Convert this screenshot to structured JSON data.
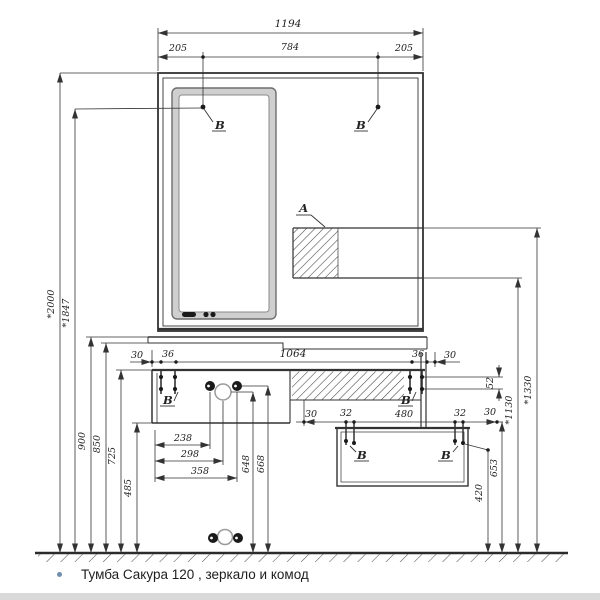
{
  "caption": {
    "bullet": "",
    "text": "Тумба Сакура 120 , зеркало и комод"
  },
  "labels": {
    "detail_a": "А",
    "detail_b": "В"
  },
  "dims": {
    "top": {
      "total": "1194",
      "left": "205",
      "center": "784",
      "right": "205"
    },
    "left": {
      "h2000": "*2000",
      "h1847": "*1847",
      "h900": "900",
      "h850": "850",
      "h725": "725",
      "h485": "485"
    },
    "vanity_row": {
      "v30l": "30",
      "v36l": "36",
      "v1064": "1064",
      "v36r": "36",
      "v30r": "30"
    },
    "right": {
      "g52": "52",
      "h1330": "*1330",
      "h1130": "*1130",
      "h653": "653",
      "h420": "420"
    },
    "plumbing": {
      "w238": "238",
      "w298": "298",
      "w358": "358",
      "h648": "648",
      "h668": "668"
    },
    "dresser_row": {
      "d30l": "30",
      "d32l": "32",
      "d480": "480",
      "d32r": "32",
      "d30r": "30"
    }
  },
  "colors": {
    "line": "#333333",
    "thick_line": "#2b2b2b",
    "mirror_frame": "#cfcfcf",
    "light_circle": "#9a9a9a",
    "dark_circle": "#1a1a1a",
    "bullet": "#6f8fae",
    "caption": "#1e1e1e"
  }
}
